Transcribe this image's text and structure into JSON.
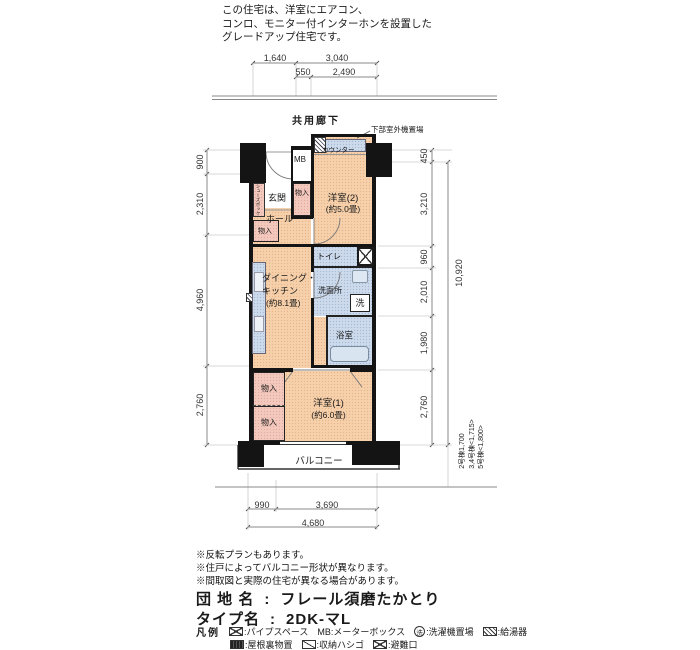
{
  "header": {
    "lines": [
      "この住宅は、洋室にエアコン、",
      "コンロ、モニター付インターホンを設置した",
      "グレードアップ住宅です。"
    ]
  },
  "corridor": {
    "label": "共用廊下"
  },
  "outdoor_unit": {
    "label": "下部室外機置場"
  },
  "dims": {
    "top1a": "1,640",
    "top1b": "3,040",
    "top2a": "550",
    "top2b": "2,490",
    "left1": "900",
    "left2": "2,310",
    "left3": "4,960",
    "left4": "2,760",
    "right1": "450",
    "right2": "3,210",
    "right3": "960",
    "right4": "2,010",
    "right5": "1,980",
    "right6": "2,760",
    "right_total": "10,920",
    "bottom1a": "990",
    "bottom1b": "3,690",
    "bottom2": "4,680",
    "building_depths": [
      "2号棟1,700",
      "3,4号棟<1,715>",
      "5号棟<1,800>"
    ]
  },
  "rooms": {
    "genkan": "玄関",
    "shoes_box": "シューズボックス",
    "mb": "MB",
    "counter": "カウンター",
    "closet": "物入",
    "hall": "ホール",
    "western2_name": "洋室(2)",
    "western2_size": "(約5.0畳)",
    "toilet": "トイレ",
    "washroom": "洗面所",
    "laundry": "洗",
    "bath": "浴室",
    "dk_line1": "ダイニング・",
    "dk_line2": "キッチン",
    "dk_size": "(約8.1畳)",
    "western1_name": "洋室(1)",
    "western1_size": "(約6.0畳)",
    "balcony": "バルコニー"
  },
  "notes": [
    "※反転プランもあります。",
    "※住戸によってバルコニー形状が異なります。",
    "※間取図と実際の住宅が異なる場合があります。"
  ],
  "info": {
    "estate_label": "団 地 名",
    "colon": ":",
    "estate_value": "フレール須磨たかとり",
    "type_label": "タイプ名",
    "type_value": "2DK-マL"
  },
  "legend": {
    "title": "凡例",
    "laundry_symbol": "洗",
    "items": [
      {
        "icon": "pipe-space-icon",
        "label": ":パイプスペース"
      },
      {
        "icon": "",
        "label": "MB:メーターボックス"
      },
      {
        "icon": "laundry-place-icon",
        "label": ":洗濯機置場"
      },
      {
        "icon": "water-heater-icon",
        "label": ":給湯器"
      },
      {
        "icon": "attic-storage-icon",
        "label": ":屋根裏物置"
      },
      {
        "icon": "storage-ladder-icon",
        "label": ":収納ハシゴ"
      },
      {
        "icon": "emergency-exit-icon",
        "label": ":避難口"
      }
    ]
  },
  "colors": {
    "room_fill": "#f6d0ab",
    "wet_fill": "#ccdaeb",
    "closet_fill": "#f3c9bd",
    "wall": "#141414"
  }
}
